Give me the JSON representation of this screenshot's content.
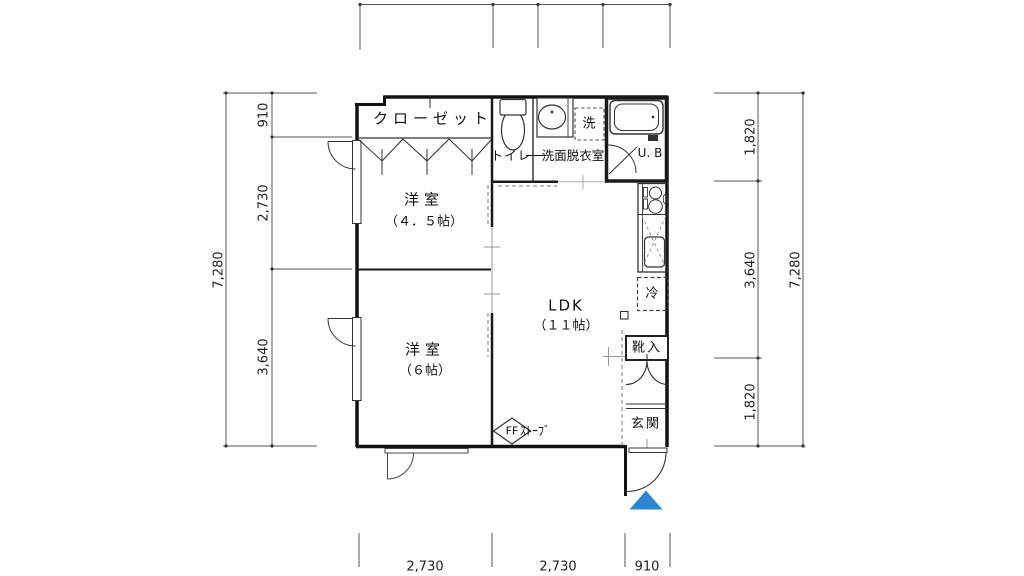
{
  "plan": {
    "closet": "クローゼット",
    "toilet": "トイレ",
    "washroom": "洗面脱衣室",
    "laundry": "洗",
    "unit_bath": "U. B",
    "room1_name": "洋室",
    "room1_size": "（４．５帖）",
    "ldk_name": "LDK",
    "ldk_size": "（１１帖）",
    "room2_name": "洋室",
    "room2_size": "（６帖）",
    "fridge": "冷",
    "shoebox": "靴入",
    "entrance": "玄関",
    "stove_symbol": "FF",
    "stove_label": "ｽﾄｰﾌﾞ"
  },
  "dimensions": {
    "left_total": "7,280",
    "left_segments": [
      "910",
      "2,730",
      "3,640"
    ],
    "right_segments": [
      "1,820",
      "3,640",
      "1,820"
    ],
    "right_total": "7,280",
    "bottom_segments": [
      "2,730",
      "2,730",
      "910"
    ]
  },
  "colors": {
    "line": "#1a1a1a",
    "entrance_marker": "#2e86d3"
  }
}
